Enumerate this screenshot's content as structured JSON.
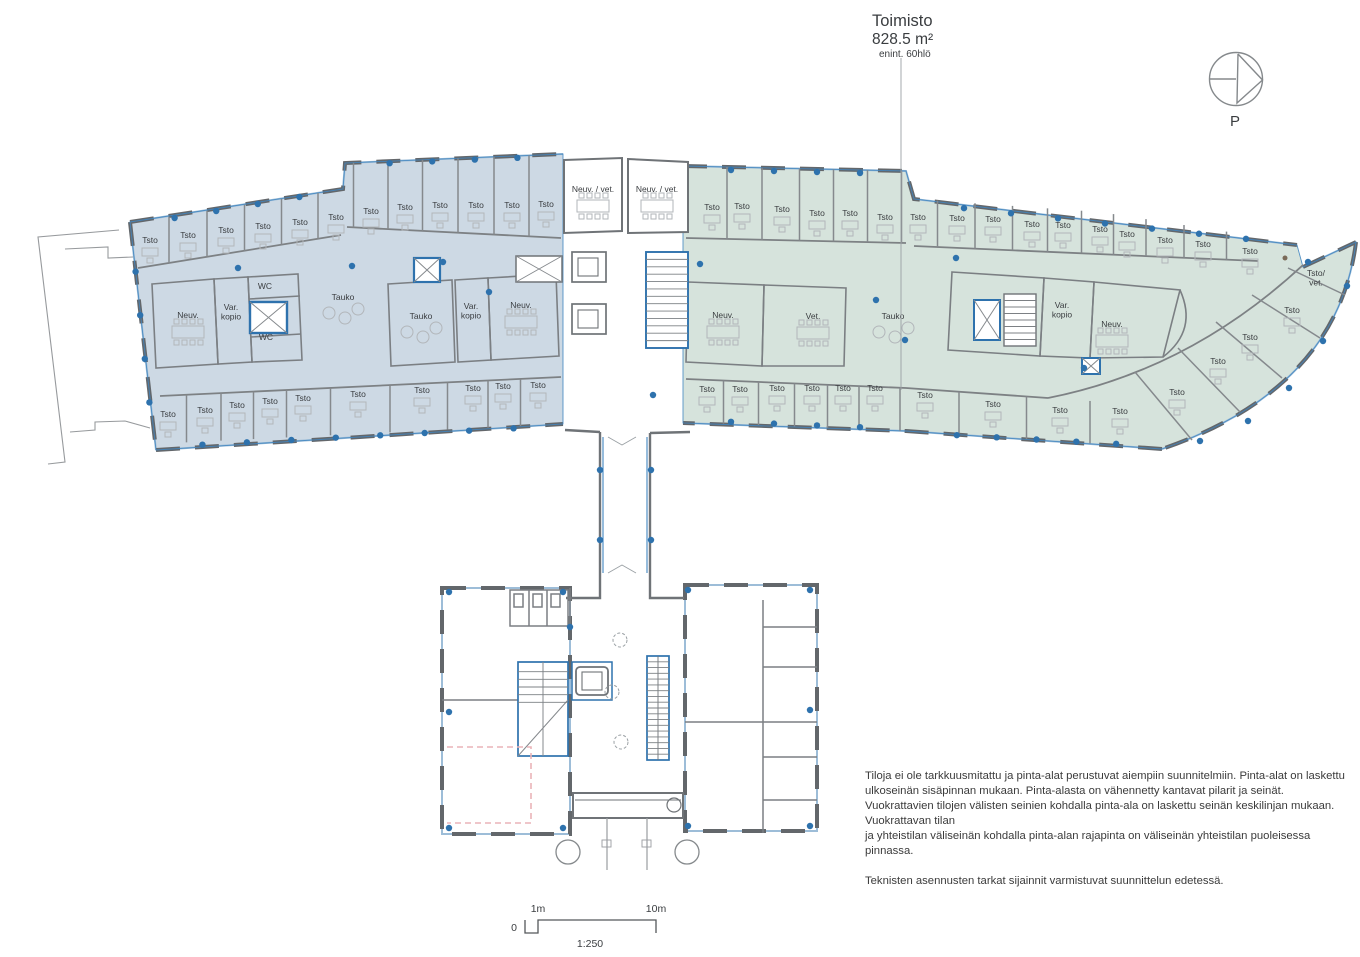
{
  "title": {
    "name": "Toimisto",
    "area": "828.5 m²",
    "capacity": "enint. 60hlö"
  },
  "north": {
    "label": "P"
  },
  "scale": {
    "zero": "0",
    "one_m": "1m",
    "ten_m": "10m",
    "ratio": "1:250"
  },
  "notes": {
    "para1": "Tiloja ei ole tarkkuusmitattu ja pinta-alat perustuvat aiempiin suunnitelmiin. Pinta-alat on laskettu ulkoseinän sisäpinnan mukaan. Pinta-alasta on vähennetty kantavat pilarit ja seinät. Vuokrattavien tilojen välisten seinien kohdalla pinta-ala on laskettu seinän keskilinjan mukaan. Vuokrattavan tilan\nja yhteistilan väliseinän kohdalla pinta-alan rajapinta on väliseinän yhteistilan puoleisessa pinnassa.",
    "para2": "Teknisten asennusten tarkat sijainnit varmistuvat suunnittelun edetessä."
  },
  "colors": {
    "left_wing_fill": "#cdd9e4",
    "right_wing_fill": "#d6e3dc",
    "wall": "#66696d",
    "accent_blue": "#2e72ad",
    "window_blue": "#9dbdd8",
    "furniture": "#b2b6ba",
    "pink_dashed": "#eab4b8"
  },
  "rooms": {
    "left_top": [
      {
        "label": "Tsto",
        "x": 150,
        "y": 243,
        "kind": "desk"
      },
      {
        "label": "Tsto",
        "x": 188,
        "y": 238,
        "kind": "desk"
      },
      {
        "label": "Tsto",
        "x": 226,
        "y": 233,
        "kind": "desk"
      },
      {
        "label": "Tsto",
        "x": 263,
        "y": 229,
        "kind": "desk"
      },
      {
        "label": "Tsto",
        "x": 300,
        "y": 225,
        "kind": "desk"
      },
      {
        "label": "Tsto",
        "x": 336,
        "y": 220,
        "kind": "desk"
      },
      {
        "label": "Tsto",
        "x": 371,
        "y": 214,
        "kind": "desk"
      },
      {
        "label": "Tsto",
        "x": 405,
        "y": 210,
        "kind": "desk"
      },
      {
        "label": "Tsto",
        "x": 440,
        "y": 208,
        "kind": "desk"
      },
      {
        "label": "Tsto",
        "x": 476,
        "y": 208,
        "kind": "desk"
      },
      {
        "label": "Tsto",
        "x": 512,
        "y": 208,
        "kind": "desk"
      },
      {
        "label": "Tsto",
        "x": 546,
        "y": 207,
        "kind": "desk"
      }
    ],
    "left_middle": [
      {
        "label": "Neuv.",
        "x": 188,
        "y": 318,
        "kind": "meet"
      },
      {
        "lines": [
          "Var.",
          "kopio"
        ],
        "x": 231,
        "y": 310,
        "kind": "none"
      },
      {
        "label": "WC",
        "x": 265,
        "y": 289,
        "kind": "none"
      },
      {
        "label": "WC",
        "x": 266,
        "y": 340,
        "kind": "none"
      },
      {
        "label": "Tauko",
        "x": 343,
        "y": 300,
        "kind": "tauko"
      },
      {
        "label": "Tauko",
        "x": 421,
        "y": 319,
        "kind": "tauko"
      },
      {
        "lines": [
          "Var.",
          "kopio"
        ],
        "x": 471,
        "y": 309,
        "kind": "none"
      },
      {
        "label": "Neuv.",
        "x": 521,
        "y": 308,
        "kind": "meet"
      }
    ],
    "left_bottom": [
      {
        "label": "Tsto",
        "x": 168,
        "y": 417,
        "kind": "desk"
      },
      {
        "label": "Tsto",
        "x": 205,
        "y": 413,
        "kind": "desk"
      },
      {
        "label": "Tsto",
        "x": 237,
        "y": 408,
        "kind": "desk"
      },
      {
        "label": "Tsto",
        "x": 270,
        "y": 404,
        "kind": "desk"
      },
      {
        "label": "Tsto",
        "x": 303,
        "y": 401,
        "kind": "desk"
      },
      {
        "label": "Tsto",
        "x": 358,
        "y": 397,
        "kind": "desk"
      },
      {
        "label": "Tsto",
        "x": 422,
        "y": 393,
        "kind": "desk"
      },
      {
        "label": "Tsto",
        "x": 473,
        "y": 391,
        "kind": "desk"
      },
      {
        "label": "Tsto",
        "x": 503,
        "y": 389,
        "kind": "desk"
      },
      {
        "label": "Tsto",
        "x": 538,
        "y": 388,
        "kind": "desk"
      }
    ],
    "core": [
      {
        "label": "Neuv. / vet.",
        "x": 593,
        "y": 192,
        "kind": "meet"
      },
      {
        "label": "Neuv. / vet.",
        "x": 657,
        "y": 192,
        "kind": "meet"
      }
    ],
    "right_top": [
      {
        "label": "Tsto",
        "x": 712,
        "y": 210,
        "kind": "desk"
      },
      {
        "label": "Tsto",
        "x": 742,
        "y": 209,
        "kind": "desk"
      },
      {
        "label": "Tsto",
        "x": 782,
        "y": 212,
        "kind": "desk"
      },
      {
        "label": "Tsto",
        "x": 817,
        "y": 216,
        "kind": "desk"
      },
      {
        "label": "Tsto",
        "x": 850,
        "y": 216,
        "kind": "desk"
      },
      {
        "label": "Tsto",
        "x": 885,
        "y": 220,
        "kind": "desk"
      },
      {
        "label": "Tsto",
        "x": 918,
        "y": 220,
        "kind": "desk"
      },
      {
        "label": "Tsto",
        "x": 957,
        "y": 221,
        "kind": "desk"
      },
      {
        "label": "Tsto",
        "x": 993,
        "y": 222,
        "kind": "desk"
      },
      {
        "label": "Tsto",
        "x": 1032,
        "y": 227,
        "kind": "desk"
      },
      {
        "label": "Tsto",
        "x": 1063,
        "y": 228,
        "kind": "desk"
      },
      {
        "label": "Tsto",
        "x": 1100,
        "y": 232,
        "kind": "desk"
      },
      {
        "label": "Tsto",
        "x": 1127,
        "y": 237,
        "kind": "desk"
      },
      {
        "label": "Tsto",
        "x": 1165,
        "y": 243,
        "kind": "desk"
      },
      {
        "label": "Tsto",
        "x": 1203,
        "y": 247,
        "kind": "desk"
      },
      {
        "label": "Tsto",
        "x": 1250,
        "y": 254,
        "kind": "desk"
      }
    ],
    "right_middle": [
      {
        "label": "Neuv.",
        "x": 723,
        "y": 318,
        "kind": "meet"
      },
      {
        "label": "Vet.",
        "x": 813,
        "y": 319,
        "kind": "meet"
      },
      {
        "label": "Tauko",
        "x": 893,
        "y": 319,
        "kind": "tauko"
      },
      {
        "lines": [
          "Var.",
          "kopio"
        ],
        "x": 1062,
        "y": 308,
        "kind": "none"
      },
      {
        "label": "Neuv.",
        "x": 1112,
        "y": 327,
        "kind": "meet"
      }
    ],
    "right_beak": [
      {
        "lines": [
          "Tsto/",
          "vet."
        ],
        "x": 1316,
        "y": 276,
        "kind": "none"
      },
      {
        "label": "Tsto",
        "x": 1292,
        "y": 313,
        "kind": "desk"
      },
      {
        "label": "Tsto",
        "x": 1250,
        "y": 340,
        "kind": "desk"
      },
      {
        "label": "Tsto",
        "x": 1218,
        "y": 364,
        "kind": "desk"
      },
      {
        "label": "Tsto",
        "x": 1177,
        "y": 395,
        "kind": "desk"
      }
    ],
    "right_bottom": [
      {
        "label": "Tsto",
        "x": 707,
        "y": 392,
        "kind": "desk"
      },
      {
        "label": "Tsto",
        "x": 740,
        "y": 392,
        "kind": "desk"
      },
      {
        "label": "Tsto",
        "x": 777,
        "y": 391,
        "kind": "desk"
      },
      {
        "label": "Tsto",
        "x": 812,
        "y": 391,
        "kind": "desk"
      },
      {
        "label": "Tsto",
        "x": 843,
        "y": 391,
        "kind": "desk"
      },
      {
        "label": "Tsto",
        "x": 875,
        "y": 391,
        "kind": "desk"
      },
      {
        "label": "Tsto",
        "x": 925,
        "y": 398,
        "kind": "desk"
      },
      {
        "label": "Tsto",
        "x": 993,
        "y": 407,
        "kind": "desk"
      },
      {
        "label": "Tsto",
        "x": 1060,
        "y": 413,
        "kind": "desk"
      },
      {
        "label": "Tsto",
        "x": 1120,
        "y": 414,
        "kind": "desk"
      }
    ]
  }
}
